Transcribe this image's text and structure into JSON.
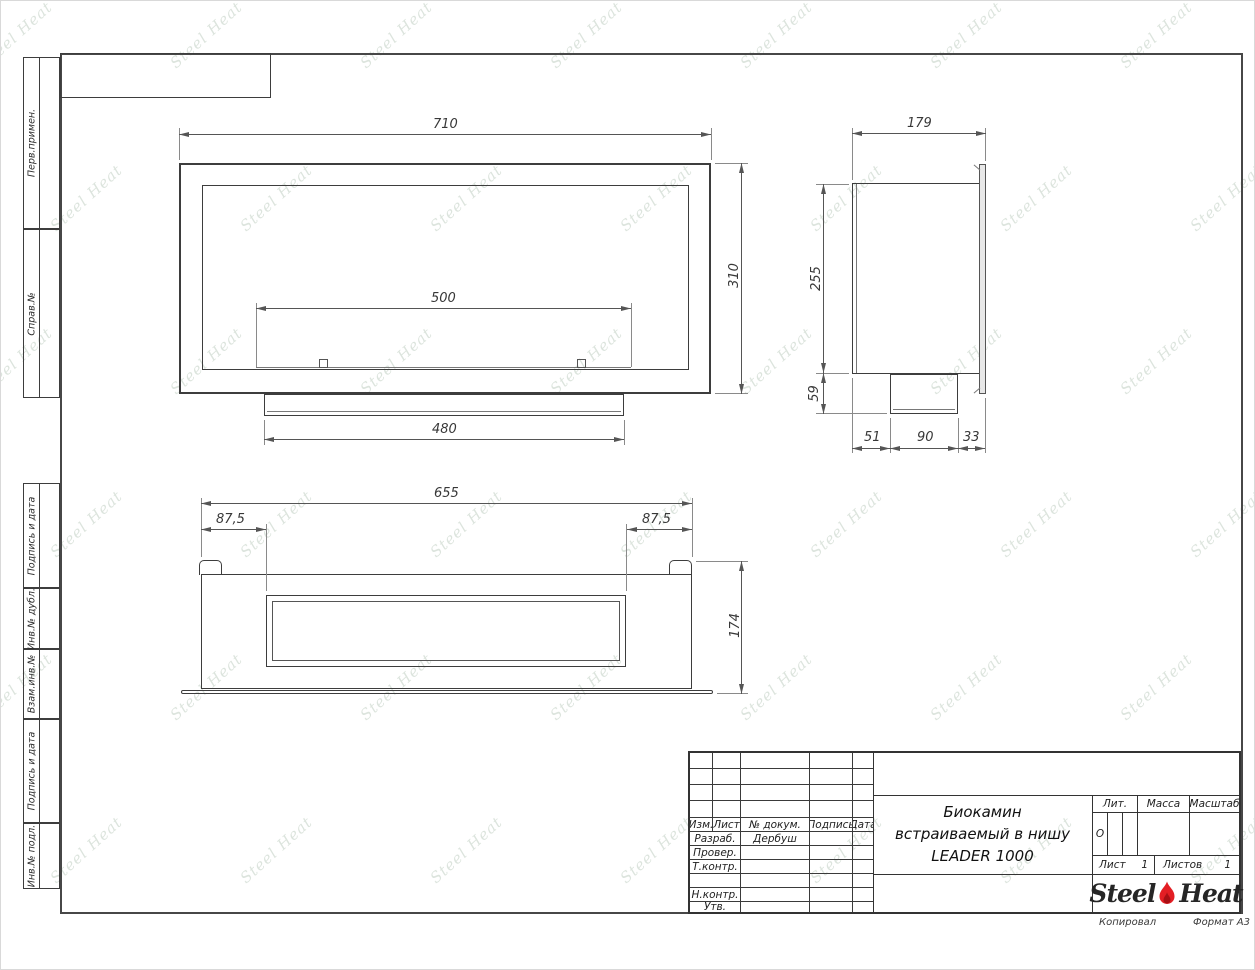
{
  "watermark_text": "Steel Heat",
  "sheet": {
    "copied_label": "Копировал",
    "format_label": "Формат А3"
  },
  "side_labels": [
    "Перв.примен.",
    "Справ.№",
    "Подпись и дата",
    "Инв.№ дубл.",
    "Взам.инв.№",
    "Подпись и дата",
    "Инв.№ подл."
  ],
  "title_block": {
    "columns": [
      "Изм.",
      "Лист",
      "№ докум.",
      "Подпись",
      "Дата"
    ],
    "rows": [
      {
        "label": "Разраб.",
        "value": "Дербуш"
      },
      {
        "label": "Провер.",
        "value": ""
      },
      {
        "label": "Т.контр.",
        "value": ""
      },
      {
        "label": "",
        "value": ""
      },
      {
        "label": "Н.контр.",
        "value": ""
      },
      {
        "label": "Утв.",
        "value": ""
      }
    ],
    "title_line1": "Биокамин",
    "title_line2": "встраиваемый в нишу",
    "title_line3": "LEADER 1000",
    "lit_label": "Лит.",
    "lit_value": "О",
    "massa_label": "Масса",
    "masshtab_label": "Масштаб",
    "list_label": "Лист",
    "list_value": "1",
    "listov_label": "Листов",
    "listov_value": "1",
    "logo_part1": "Steel",
    "logo_part2": "Heat",
    "logo_flame_color": "#e31e24"
  },
  "views": {
    "front": {
      "dims": {
        "width": "710",
        "height": "310",
        "burner_width": "500",
        "tray_width": "480"
      }
    },
    "side": {
      "dims": {
        "depth": "179",
        "body_height": "255",
        "tank_height": "59",
        "seg1": "51",
        "seg2": "90",
        "seg3": "33"
      }
    },
    "top": {
      "dims": {
        "width": "655",
        "offset_left": "87,5",
        "offset_right": "87,5",
        "depth": "174"
      }
    }
  }
}
